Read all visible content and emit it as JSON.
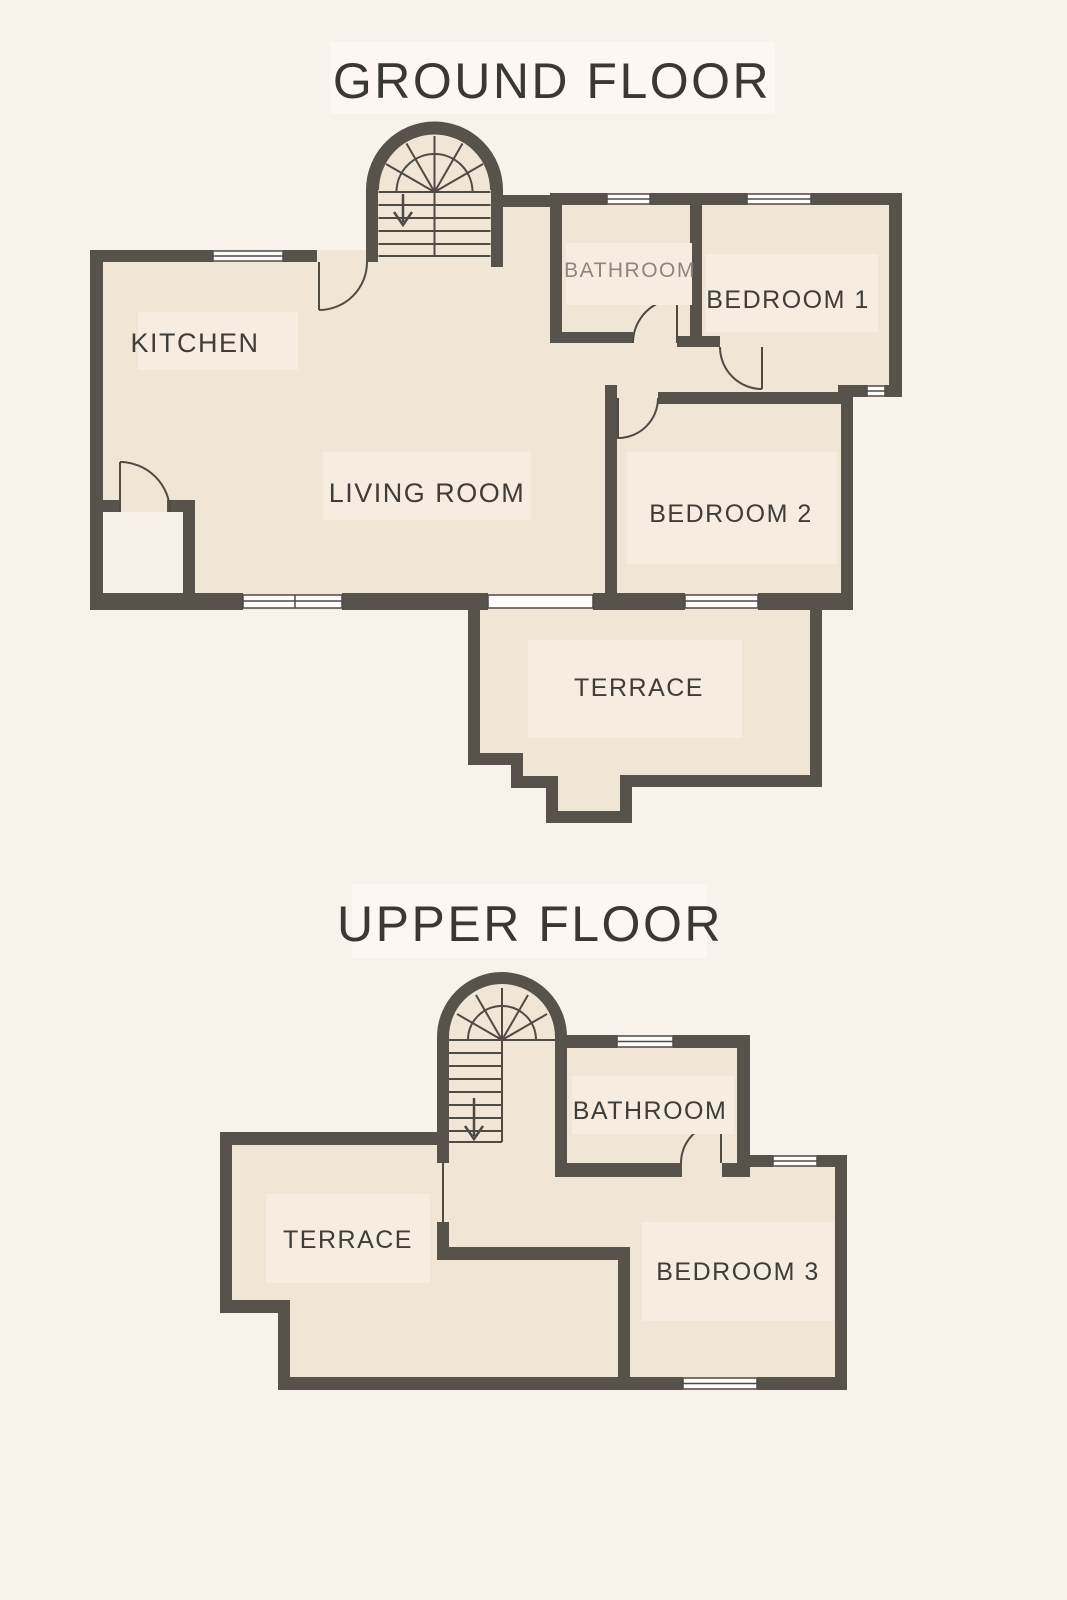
{
  "colors": {
    "background": "#f9f2eb",
    "room": "#f1e5d6",
    "room_light": "#f8f1e7",
    "patch": "#f6ecdf",
    "title_patch": "#fcf7f0",
    "wall": "#57524a",
    "thin": "#4e4a44",
    "window": "#fefdfa",
    "text": "#3f3d38",
    "text_muted": "#8b8780",
    "title": "#393833"
  },
  "ground_floor": {
    "title": "GROUND FLOOR",
    "rooms": {
      "kitchen": "KITCHEN",
      "living_room": "LIVING ROOM",
      "bathroom": "BATHROOM",
      "bedroom1": "BEDROOM 1",
      "bedroom2": "BEDROOM 2",
      "terrace": "TERRACE"
    }
  },
  "upper_floor": {
    "title": "UPPER FLOOR",
    "rooms": {
      "bathroom": "BATHROOM",
      "bedroom3": "BEDROOM 3",
      "terrace": "TERRACE"
    }
  }
}
